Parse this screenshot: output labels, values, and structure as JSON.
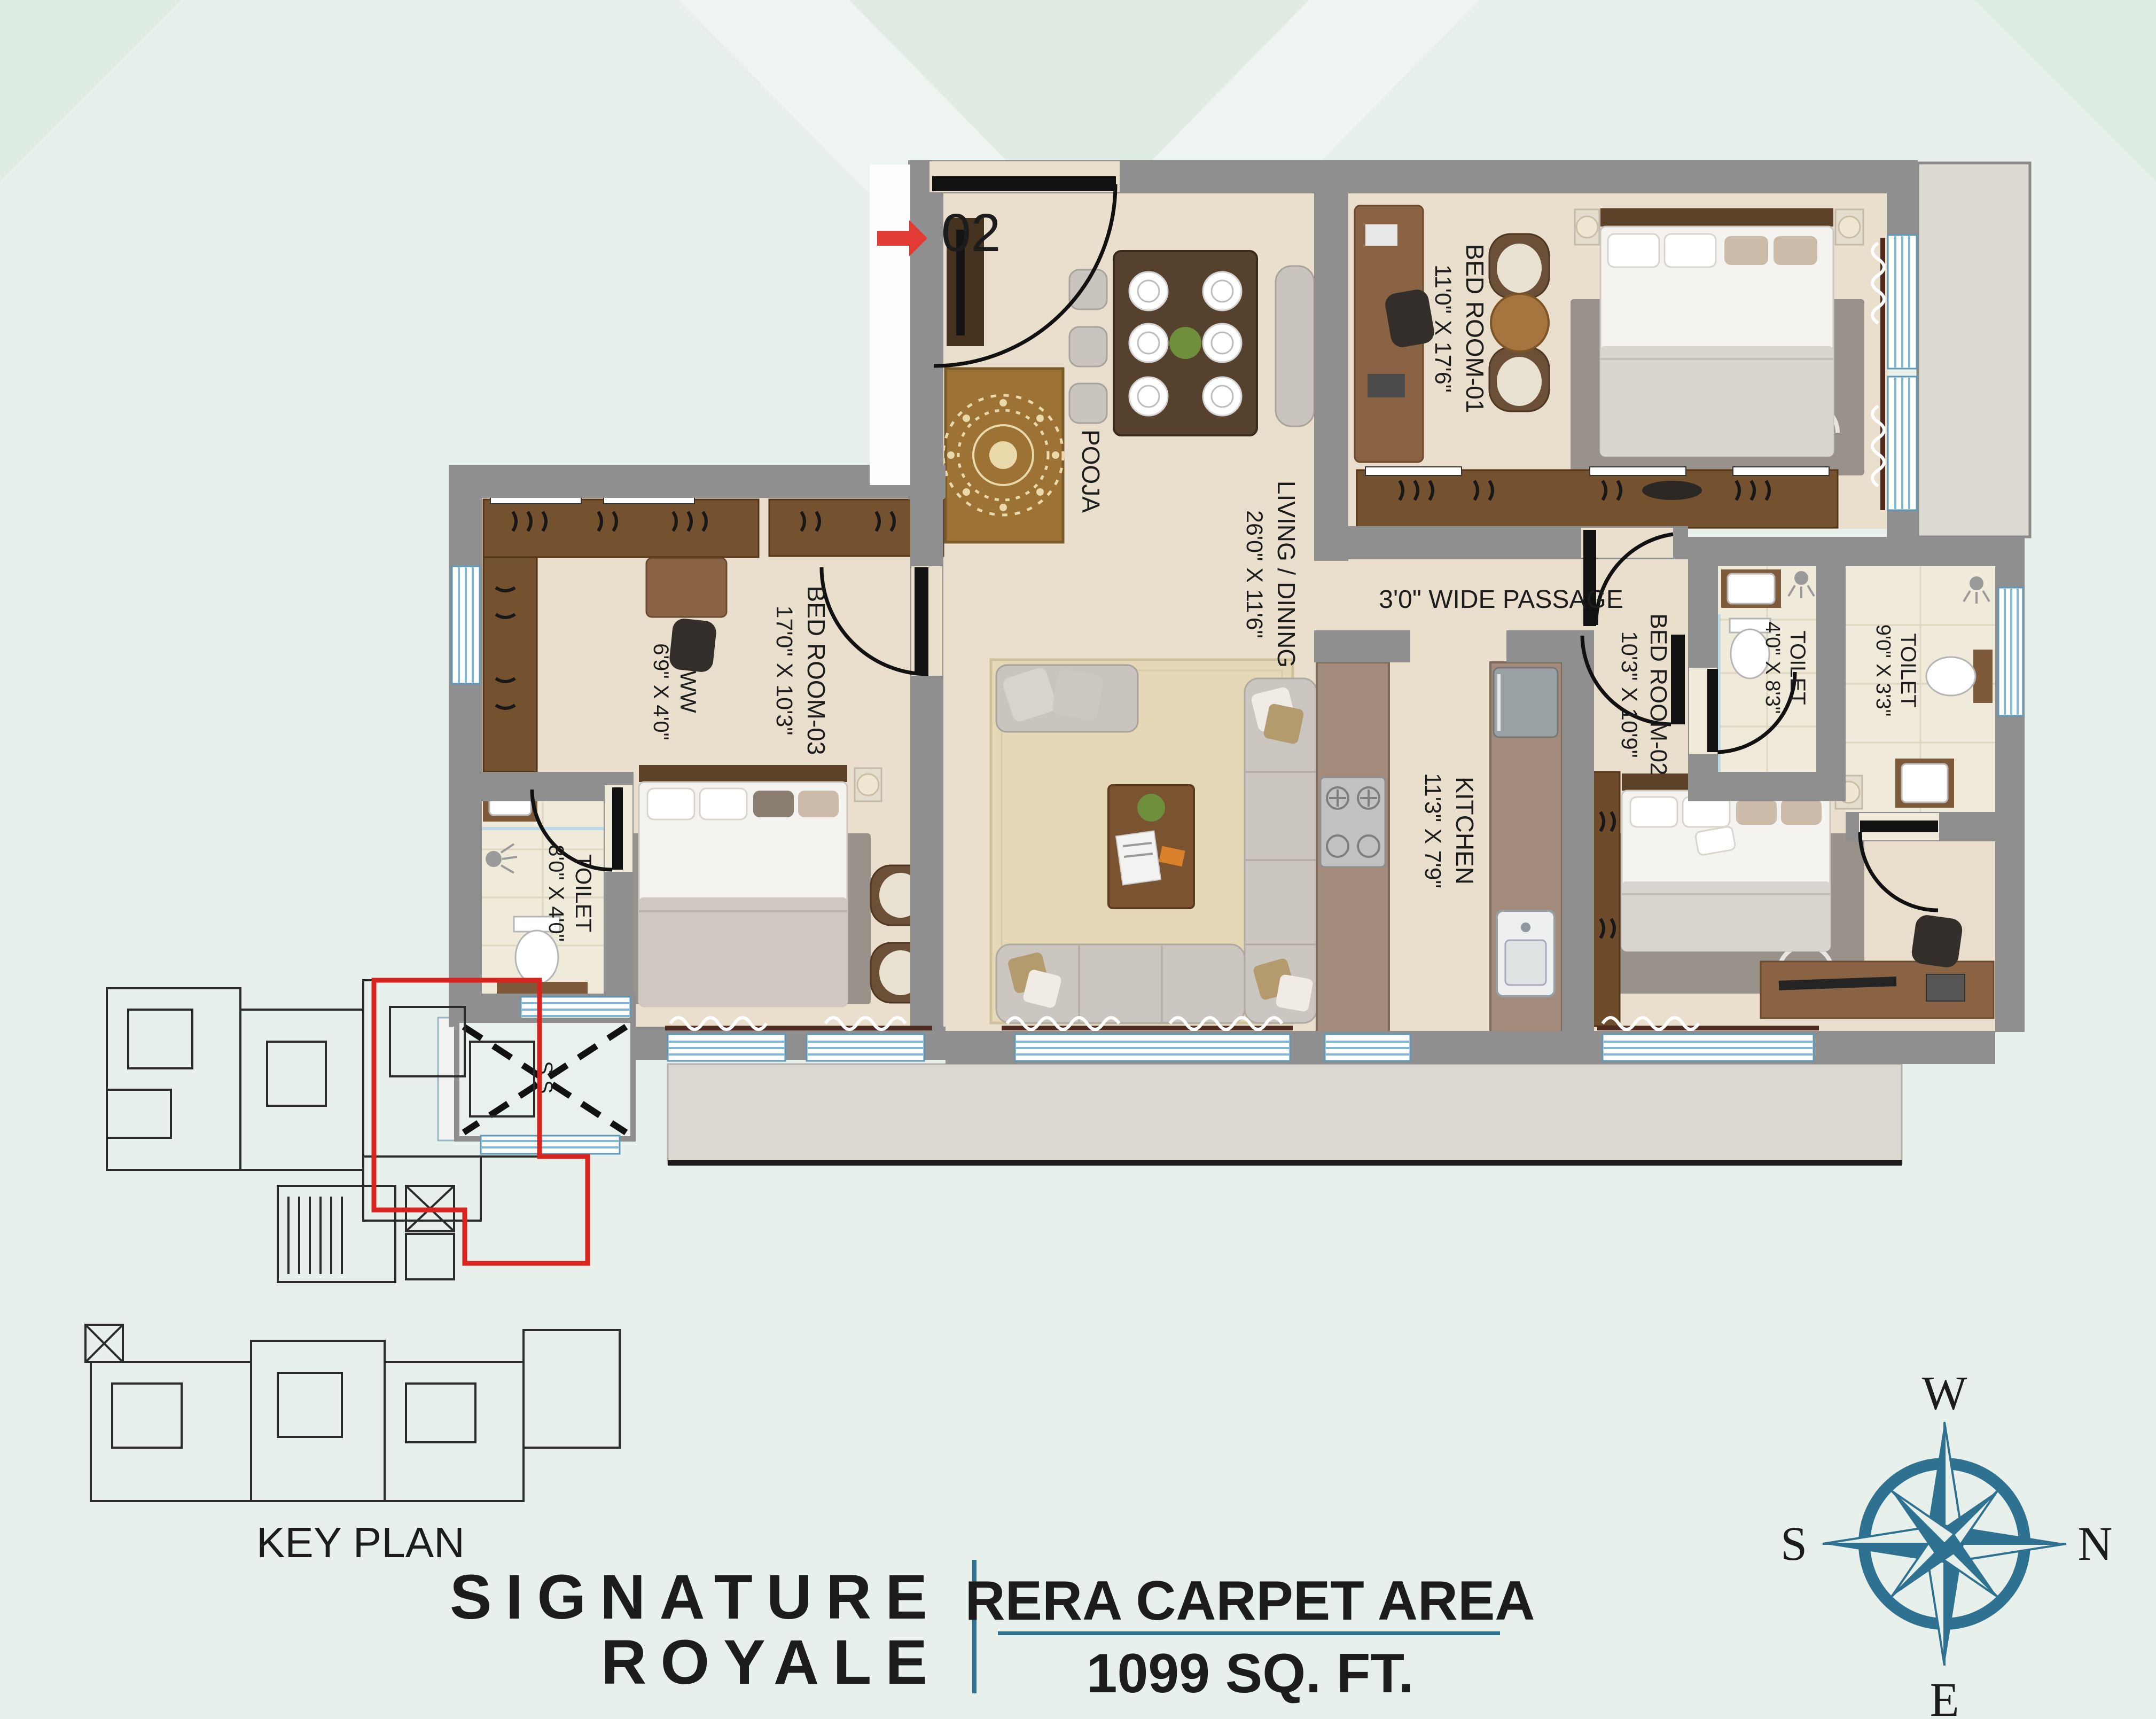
{
  "plan": {
    "unit_number": "02",
    "rooms": {
      "bedroom1": {
        "name": "BED ROOM-01",
        "dims": "11'0\" X 17'6\""
      },
      "living": {
        "name": "LIVING / DINING",
        "dims": "26'0\" X 11'6\""
      },
      "pooja": {
        "name": "POOJA"
      },
      "passage": {
        "name": "3'0\" WIDE PASSAGE"
      },
      "bedroom3": {
        "name": "BED ROOM-03",
        "dims": "17'0\" X 10'3\""
      },
      "ww": {
        "name": "WW",
        "dims": "6'9\" X 4'0\""
      },
      "toilet_left": {
        "name": "TOILET",
        "dims": "8'0\" X 4'0\""
      },
      "kitchen": {
        "name": "KITCHEN",
        "dims": "11'3\" X 7'9\""
      },
      "bedroom2": {
        "name": "BED ROOM-02",
        "dims": "10'3\" X 10'9\""
      },
      "toilet_a": {
        "name": "TOILET",
        "dims": "4'0\" X 8'3\""
      },
      "toilet_b": {
        "name": "TOILET",
        "dims": "9'0\" X 3'3\""
      },
      "shaft": {
        "name": "S.S."
      }
    }
  },
  "key_plan": {
    "label": "KEY PLAN"
  },
  "brand": {
    "line1": "SIGNATURE",
    "line2": "ROYALE"
  },
  "area": {
    "label": "RERA CARPET AREA",
    "value": "1099 SQ. FT."
  },
  "compass": {
    "top": "W",
    "right": "N",
    "left": "S",
    "bottom": "E"
  },
  "colors": {
    "teal": "#2E7191",
    "red": "#E23B33",
    "wall": "#8F8F8F",
    "floor": "#EADFCD",
    "background": "#E7F0EA"
  }
}
